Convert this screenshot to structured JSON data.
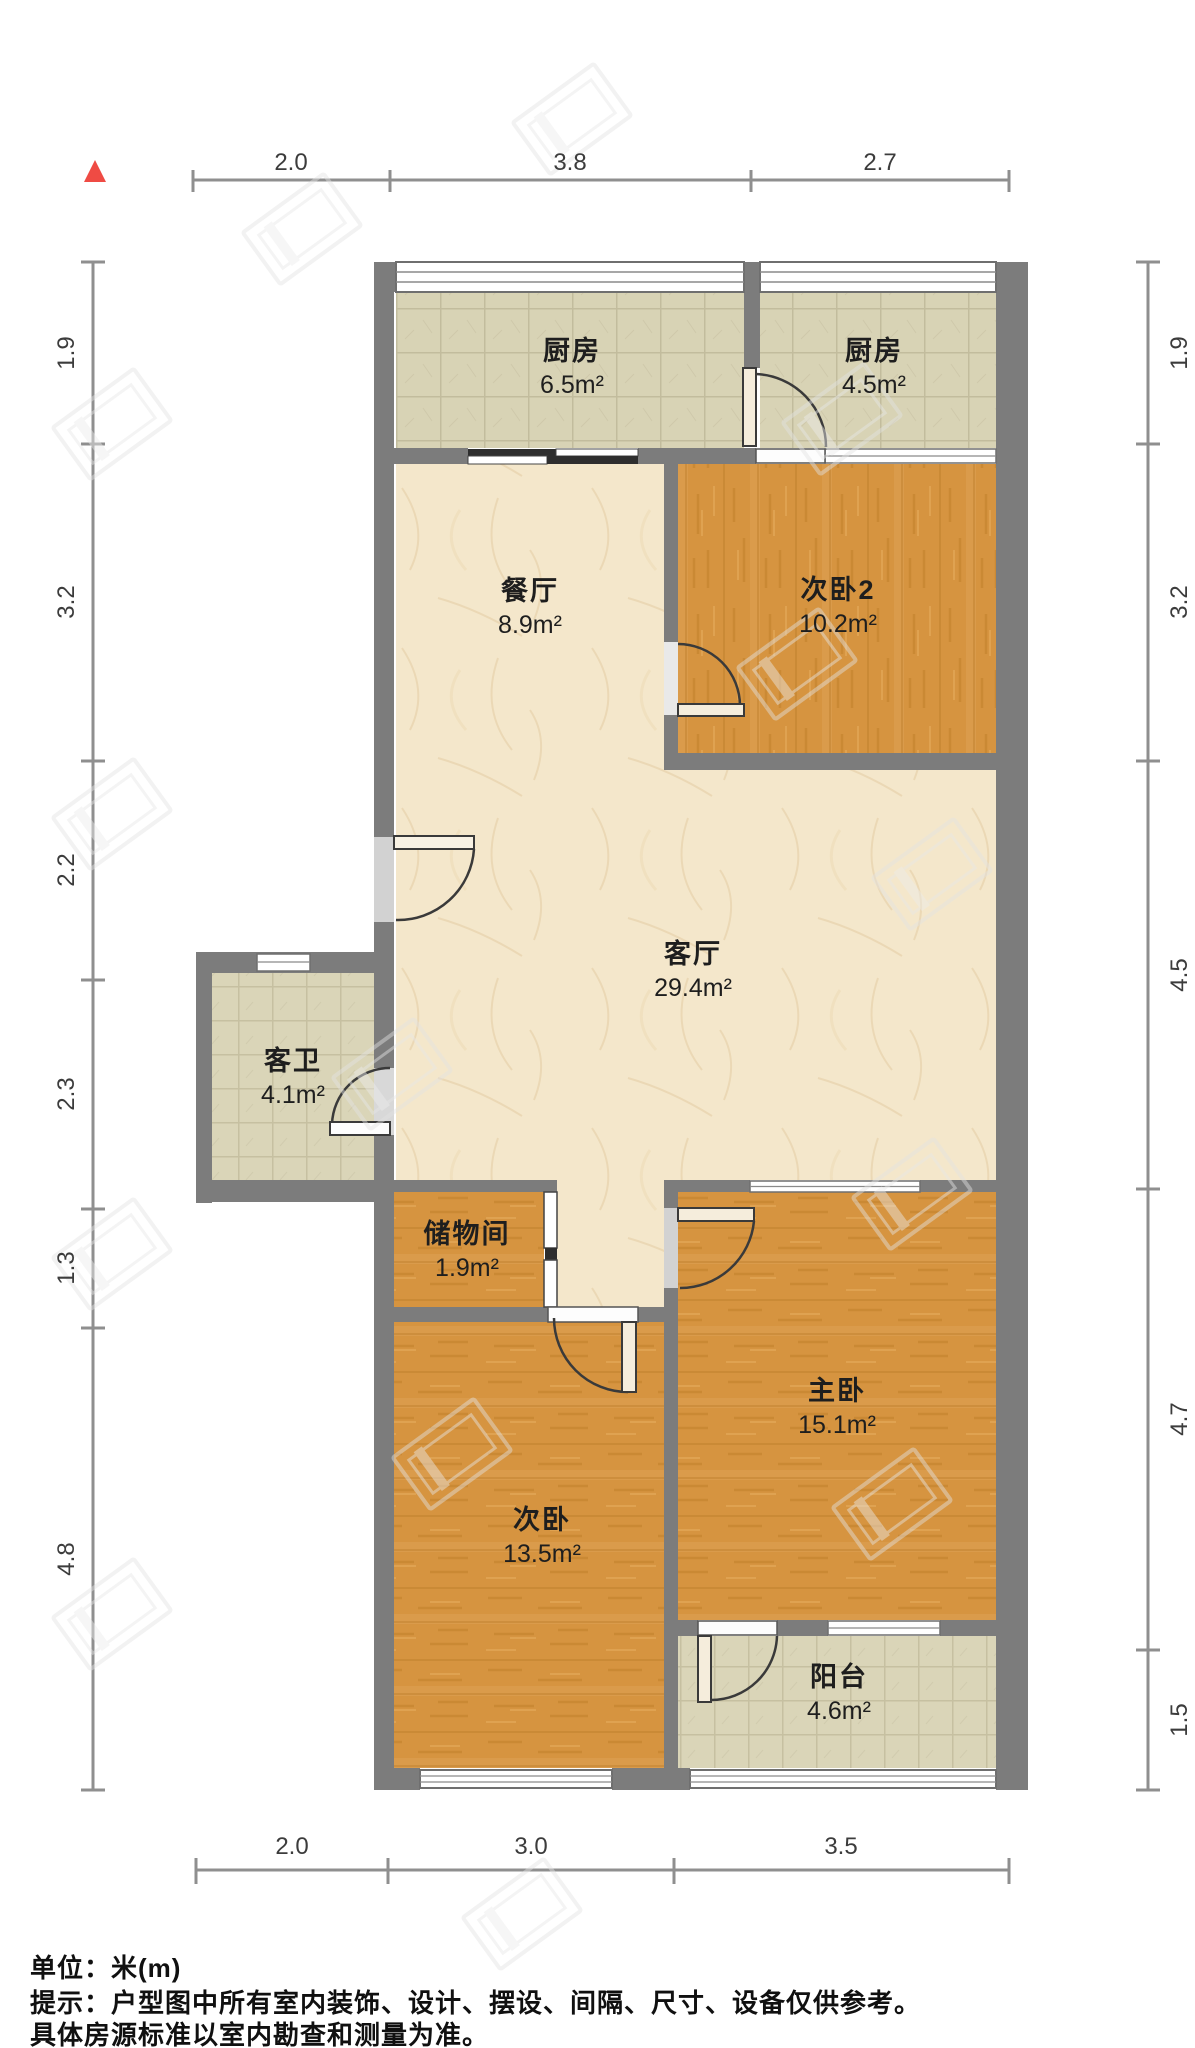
{
  "page": {
    "background": "#ffffff"
  },
  "plan": {
    "compass": {
      "icon": "north-triangle",
      "color": "#ef4b44"
    },
    "rooms": [
      {
        "id": "kitchen-west",
        "name": "厨房",
        "area": "6.5m²"
      },
      {
        "id": "kitchen-east",
        "name": "厨房",
        "area": "4.5m²"
      },
      {
        "id": "dining",
        "name": "餐厅",
        "area": "8.9m²"
      },
      {
        "id": "bedroom2",
        "name": "次卧2",
        "area": "10.2m²"
      },
      {
        "id": "living",
        "name": "客厅",
        "area": "29.4m²"
      },
      {
        "id": "guest-bath",
        "name": "客卫",
        "area": "4.1m²"
      },
      {
        "id": "storage",
        "name": "储物间",
        "area": "1.9m²"
      },
      {
        "id": "master-bedroom",
        "name": "主卧",
        "area": "15.1m²"
      },
      {
        "id": "bedroom",
        "name": "次卧",
        "area": "13.5m²"
      },
      {
        "id": "balcony",
        "name": "阳台",
        "area": "4.6m²"
      }
    ],
    "dimensions": {
      "top": [
        "2.0",
        "3.8",
        "2.7"
      ],
      "bottom": [
        "2.0",
        "3.0",
        "3.5"
      ],
      "left": [
        "1.9",
        "3.2",
        "2.2",
        "2.3",
        "1.3",
        "4.8"
      ],
      "right": [
        "1.9",
        "3.2",
        "4.5",
        "4.7",
        "1.5"
      ]
    },
    "colors": {
      "wall": "#7c7c7c",
      "wood_floor": "#d79742",
      "tile_floor": "#d8d3b5",
      "marble_floor": "#f4e7cb",
      "dimension_line": "#8f8f8f",
      "compass_red": "#ef4b44"
    }
  },
  "footer": {
    "unit_line": "单位：米(m)",
    "disclaimer_line1": "提示：户型图中所有室内装饰、设计、摆设、间隔、尺寸、设备仅供参考。",
    "disclaimer_line2": "具体房源标准以室内勘查和测量为准。"
  }
}
